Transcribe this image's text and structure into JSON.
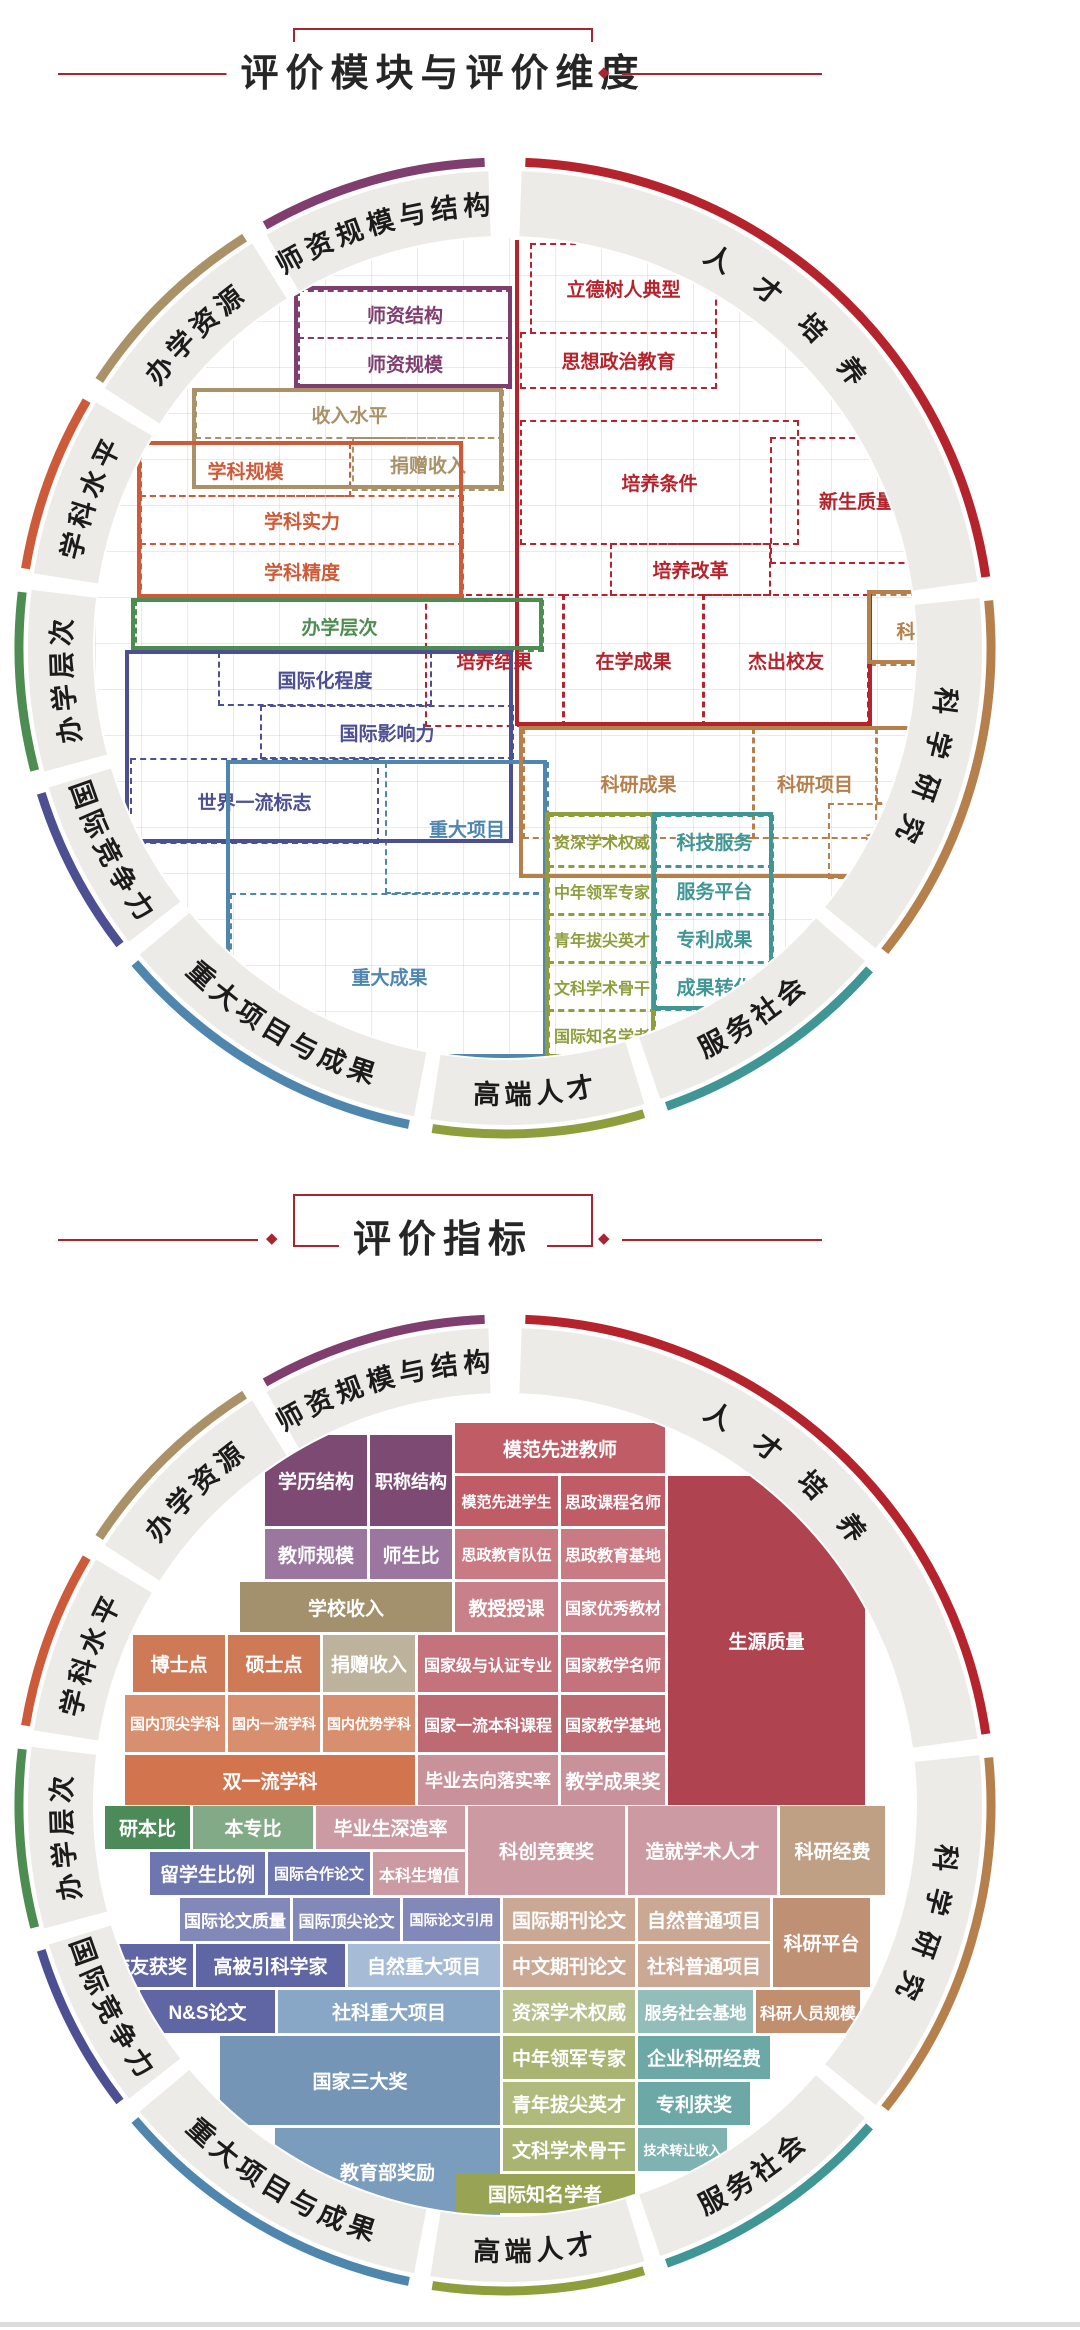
{
  "titles": {
    "module_dimension": "评价模块与评价维度",
    "indicator": "评价指标"
  },
  "accent_color": "#a82430",
  "diamond_icon": "◆",
  "module_colors": {
    "purple": "#7f3e6e",
    "red": "#b5232c",
    "tan": "#ab9168",
    "orange": "#cd5b39",
    "green": "#4e8d52",
    "navy": "#4c4f91",
    "steel": "#4f86ae",
    "camel": "#b5804c",
    "olive": "#8f9e3d",
    "teal": "#3f9695"
  },
  "ring": {
    "band_color": "#edebe8",
    "label_color": "#1b1b1b",
    "segments": [
      {
        "label": "人才培养",
        "color": "#b5232c",
        "a0": 2,
        "a1": 82,
        "flip": false
      },
      {
        "label": "科学研究",
        "color": "#b5804c",
        "a0": 84,
        "a1": 129,
        "flip": false
      },
      {
        "label": "服务社会",
        "color": "#3f9695",
        "a0": 131,
        "a1": 161,
        "flip": true
      },
      {
        "label": "高端人才",
        "color": "#8f9e3d",
        "a0": 163,
        "a1": 189,
        "flip": true
      },
      {
        "label": "重大项目与成果",
        "color": "#4f86ae",
        "a0": 191,
        "a1": 230,
        "flip": true
      },
      {
        "label": "国际竞争力",
        "color": "#4c4f91",
        "a0": 232,
        "a1": 253,
        "flip": true
      },
      {
        "label": "办学层次",
        "color": "#4e8d52",
        "a0": 255,
        "a1": 277,
        "flip": false
      },
      {
        "label": "学科水平",
        "color": "#cd5b39",
        "a0": 279,
        "a1": 301,
        "flip": false
      },
      {
        "label": "办学资源",
        "color": "#ab9168",
        "a0": 303,
        "a1": 328,
        "flip": false
      },
      {
        "label": "师资规模与结构",
        "color": "#7f3e6e",
        "a0": 330,
        "a1": 358,
        "flip": false
      }
    ]
  },
  "wheel1": {
    "cells": [
      {
        "t": "师资结构",
        "x": 203,
        "y": 52,
        "w": 210,
        "h": 45,
        "c": "purple"
      },
      {
        "t": "师资规模",
        "x": 203,
        "y": 99,
        "w": 210,
        "h": 48,
        "c": "purple"
      },
      {
        "t": "立德树人典型",
        "x": 435,
        "y": 5,
        "w": 183,
        "h": 87,
        "c": "red"
      },
      {
        "t": "思想政治教育",
        "x": 425,
        "y": 94,
        "w": 193,
        "h": 53,
        "c": "red"
      },
      {
        "t": "培养条件",
        "x": 425,
        "y": 182,
        "w": 275,
        "h": 121,
        "c": "red"
      },
      {
        "t": "培养改革",
        "x": 515,
        "y": 305,
        "w": 157,
        "h": 49,
        "c": "red"
      },
      {
        "t": "新生质量",
        "x": 675,
        "y": 199,
        "w": 170,
        "h": 123,
        "c": "red"
      },
      {
        "t": "培养结果",
        "x": 330,
        "y": 356,
        "w": 135,
        "h": 129,
        "c": "red"
      },
      {
        "t": "在学成果",
        "x": 468,
        "y": 356,
        "w": 137,
        "h": 129,
        "c": "red"
      },
      {
        "t": "杰出校友",
        "x": 608,
        "y": 356,
        "w": 162,
        "h": 129,
        "c": "red"
      },
      {
        "t": "收入水平",
        "x": 100,
        "y": 152,
        "w": 305,
        "h": 45,
        "c": "tan"
      },
      {
        "t": "捐赠收入",
        "x": 257,
        "y": 199,
        "w": 148,
        "h": 50,
        "c": "tan"
      },
      {
        "t": "学科规模",
        "x": 45,
        "y": 205,
        "w": 207,
        "h": 50,
        "c": "orange"
      },
      {
        "t": "学科实力",
        "x": 45,
        "y": 257,
        "w": 320,
        "h": 46,
        "c": "orange"
      },
      {
        "t": "学科精度",
        "x": 45,
        "y": 305,
        "w": 320,
        "h": 53,
        "c": "orange"
      },
      {
        "t": "办学层次",
        "x": 40,
        "y": 362,
        "w": 405,
        "h": 48,
        "c": "green"
      },
      {
        "t": "国际化程度",
        "x": 123,
        "y": 414,
        "w": 210,
        "h": 50,
        "c": "navy"
      },
      {
        "t": "国际影响力",
        "x": 165,
        "y": 467,
        "w": 250,
        "h": 50,
        "c": "navy"
      },
      {
        "t": "世界一流标志",
        "x": 35,
        "y": 520,
        "w": 245,
        "h": 82,
        "c": "navy"
      },
      {
        "t": "重大项目",
        "x": 290,
        "y": 524,
        "w": 160,
        "h": 128,
        "c": "steel"
      },
      {
        "t": "重大成果",
        "x": 135,
        "y": 655,
        "w": 315,
        "h": 163,
        "c": "steel"
      },
      {
        "t": "科研经费",
        "x": 775,
        "y": 356,
        "w": 125,
        "h": 68,
        "c": "camel"
      },
      {
        "t": "科研成果",
        "x": 428,
        "y": 490,
        "w": 227,
        "h": 107,
        "c": "camel"
      },
      {
        "t": "科研项目",
        "x": 658,
        "y": 490,
        "w": 120,
        "h": 107,
        "c": "camel"
      },
      {
        "t": "科研平台",
        "x": 781,
        "y": 490,
        "w": 119,
        "h": 72,
        "c": "camel"
      },
      {
        "t": "科研人力",
        "x": 733,
        "y": 565,
        "w": 147,
        "h": 72,
        "c": "camel"
      },
      {
        "t": "资深学术权威",
        "x": 453,
        "y": 577,
        "w": 104,
        "h": 48,
        "c": "olive"
      },
      {
        "t": "中年领军专家",
        "x": 453,
        "y": 628,
        "w": 104,
        "h": 45,
        "c": "olive"
      },
      {
        "t": "青年拔尖英才",
        "x": 453,
        "y": 676,
        "w": 104,
        "h": 45,
        "c": "olive"
      },
      {
        "t": "文科学术骨干",
        "x": 453,
        "y": 724,
        "w": 104,
        "h": 45,
        "c": "olive"
      },
      {
        "t": "国际知名学者",
        "x": 453,
        "y": 772,
        "w": 104,
        "h": 45,
        "c": "olive"
      },
      {
        "t": "科技服务",
        "x": 560,
        "y": 577,
        "w": 115,
        "h": 48,
        "c": "teal"
      },
      {
        "t": "服务平台",
        "x": 560,
        "y": 628,
        "w": 115,
        "h": 45,
        "c": "teal"
      },
      {
        "t": "专利成果",
        "x": 560,
        "y": 676,
        "w": 115,
        "h": 45,
        "c": "teal"
      },
      {
        "t": "成果转化",
        "x": 560,
        "y": 724,
        "w": 115,
        "h": 45,
        "c": "teal"
      }
    ],
    "outlines": [
      {
        "kind": "box",
        "x": 199,
        "y": 48,
        "w": 218,
        "h": 102,
        "c": "purple"
      },
      {
        "kind": "bar",
        "x": 420,
        "y": 2,
        "w": 4,
        "h": 486,
        "c": "red"
      },
      {
        "kind": "bar",
        "x": 420,
        "y": 484,
        "w": 357,
        "h": 4,
        "c": "red"
      },
      {
        "kind": "bar",
        "x": 773,
        "y": 352,
        "w": 4,
        "h": 136,
        "c": "red"
      },
      {
        "kind": "box",
        "x": 97,
        "y": 150,
        "w": 311,
        "h": 101,
        "c": "tan"
      },
      {
        "kind": "box",
        "x": 42,
        "y": 203,
        "w": 326,
        "h": 157,
        "c": "orange"
      },
      {
        "kind": "box",
        "x": 36,
        "y": 360,
        "w": 412,
        "h": 52,
        "c": "green"
      },
      {
        "kind": "box",
        "x": 30,
        "y": 412,
        "w": 388,
        "h": 193,
        "c": "navy"
      },
      {
        "kind": "box",
        "x": 131,
        "y": 522,
        "w": 321,
        "h": 298,
        "c": "steel"
      },
      {
        "kind": "box",
        "x": 772,
        "y": 352,
        "w": 131,
        "h": 74,
        "c": "camel"
      },
      {
        "kind": "box",
        "x": 424,
        "y": 488,
        "w": 479,
        "h": 152,
        "c": "camel"
      },
      {
        "kind": "box",
        "x": 450,
        "y": 574,
        "w": 110,
        "h": 246,
        "c": "olive"
      },
      {
        "kind": "box",
        "x": 557,
        "y": 574,
        "w": 121,
        "h": 198,
        "c": "teal"
      }
    ]
  },
  "wheel2": {
    "cells": [
      {
        "t": "模范先进教师",
        "x": 360,
        "y": 28,
        "w": 210,
        "h": 50,
        "c": "#c05c66"
      },
      {
        "t": "学历结构",
        "x": 170,
        "y": 40,
        "w": 102,
        "h": 91,
        "c": "#7c4a73"
      },
      {
        "t": "职称结构",
        "x": 275,
        "y": 40,
        "w": 82,
        "h": 91,
        "c": "#7c4a73"
      },
      {
        "t": "模范先进学生",
        "x": 360,
        "y": 81,
        "w": 103,
        "h": 50,
        "c": "#c05c66"
      },
      {
        "t": "思政课程名师",
        "x": 466,
        "y": 81,
        "w": 104,
        "h": 50,
        "c": "#c05c66"
      },
      {
        "t": "教师规模",
        "x": 170,
        "y": 134,
        "w": 102,
        "h": 50,
        "c": "#9b77a0"
      },
      {
        "t": "师生比",
        "x": 275,
        "y": 134,
        "w": 82,
        "h": 50,
        "c": "#9b77a0"
      },
      {
        "t": "思政教育队伍",
        "x": 360,
        "y": 134,
        "w": 103,
        "h": 50,
        "c": "#ca7a82"
      },
      {
        "t": "思政教育基地",
        "x": 466,
        "y": 134,
        "w": 104,
        "h": 50,
        "c": "#ca7a82"
      },
      {
        "t": "学校收入",
        "x": 145,
        "y": 187,
        "w": 212,
        "h": 50,
        "c": "#a3906c"
      },
      {
        "t": "教授授课",
        "x": 360,
        "y": 187,
        "w": 103,
        "h": 50,
        "c": "#c98189"
      },
      {
        "t": "国家优秀教材",
        "x": 466,
        "y": 187,
        "w": 104,
        "h": 50,
        "c": "#c98189"
      },
      {
        "t": "博士点",
        "x": 38,
        "y": 240,
        "w": 92,
        "h": 57,
        "c": "#ce7a57"
      },
      {
        "t": "硕士点",
        "x": 133,
        "y": 240,
        "w": 92,
        "h": 57,
        "c": "#ce7a57"
      },
      {
        "t": "捐赠收入",
        "x": 228,
        "y": 240,
        "w": 92,
        "h": 57,
        "c": "#bdb29b"
      },
      {
        "t": "国家级与认证专业",
        "x": 323,
        "y": 240,
        "w": 140,
        "h": 57,
        "c": "#c4737c"
      },
      {
        "t": "国家教学名师",
        "x": 466,
        "y": 240,
        "w": 104,
        "h": 57,
        "c": "#c4737c"
      },
      {
        "t": "生源质量",
        "x": 573,
        "y": 81,
        "w": 197,
        "h": 329,
        "c": "#b04350"
      },
      {
        "t": "国内顶尖学科",
        "x": 30,
        "y": 300,
        "w": 100,
        "h": 57,
        "c": "#d88f70"
      },
      {
        "t": "国内一流学科",
        "x": 133,
        "y": 300,
        "w": 92,
        "h": 57,
        "c": "#d88f70"
      },
      {
        "t": "国内优势学科",
        "x": 228,
        "y": 300,
        "w": 92,
        "h": 57,
        "c": "#d88f70"
      },
      {
        "t": "国家一流本科课程",
        "x": 323,
        "y": 300,
        "w": 140,
        "h": 57,
        "c": "#bd6a73"
      },
      {
        "t": "国家教学基地",
        "x": 466,
        "y": 300,
        "w": 104,
        "h": 57,
        "c": "#bd6a73"
      },
      {
        "t": "双一流学科",
        "x": 30,
        "y": 360,
        "w": 290,
        "h": 50,
        "c": "#d2744e"
      },
      {
        "t": "毕业去向落实率",
        "x": 323,
        "y": 360,
        "w": 140,
        "h": 50,
        "c": "#c9929b"
      },
      {
        "t": "教学成果奖",
        "x": 466,
        "y": 360,
        "w": 104,
        "h": 50,
        "c": "#c9929b"
      },
      {
        "t": "研本比",
        "x": 10,
        "y": 411,
        "w": 85,
        "h": 43,
        "c": "#4c8a59"
      },
      {
        "t": "本专比",
        "x": 98,
        "y": 411,
        "w": 120,
        "h": 43,
        "c": "#83aa87"
      },
      {
        "t": "毕业生深造率",
        "x": 221,
        "y": 411,
        "w": 149,
        "h": 43,
        "c": "#cc9aa3"
      },
      {
        "t": "科创竞赛奖",
        "x": 373,
        "y": 411,
        "w": 157,
        "h": 89,
        "c": "#cc9aa3"
      },
      {
        "t": "造就学术人才",
        "x": 533,
        "y": 411,
        "w": 149,
        "h": 89,
        "c": "#cc9aa3"
      },
      {
        "t": "科研经费",
        "x": 685,
        "y": 411,
        "w": 105,
        "h": 89,
        "c": "#bfa084"
      },
      {
        "t": "留学生比例",
        "x": 55,
        "y": 457,
        "w": 115,
        "h": 43,
        "c": "#6d76af"
      },
      {
        "t": "国际合作论文",
        "x": 173,
        "y": 457,
        "w": 102,
        "h": 43,
        "c": "#6d76af"
      },
      {
        "t": "本科生增值",
        "x": 278,
        "y": 457,
        "w": 92,
        "h": 43,
        "c": "#cc9aa3"
      },
      {
        "t": "国际论文质量",
        "x": 85,
        "y": 503,
        "w": 110,
        "h": 43,
        "c": "#8289b8"
      },
      {
        "t": "国际顶尖论文",
        "x": 198,
        "y": 503,
        "w": 107,
        "h": 43,
        "c": "#8289b8"
      },
      {
        "t": "国际论文引用",
        "x": 308,
        "y": 503,
        "w": 97,
        "h": 43,
        "c": "#8289b8"
      },
      {
        "t": "国际期刊论文",
        "x": 408,
        "y": 503,
        "w": 132,
        "h": 43,
        "c": "#cba893"
      },
      {
        "t": "自然普通项目",
        "x": 543,
        "y": 503,
        "w": 132,
        "h": 43,
        "c": "#cba893"
      },
      {
        "t": "科研平台",
        "x": 678,
        "y": 503,
        "w": 97,
        "h": 89,
        "c": "#c09074"
      },
      {
        "t": "校友获奖",
        "x": 10,
        "y": 549,
        "w": 88,
        "h": 43,
        "c": "#5f66a3"
      },
      {
        "t": "高被引科学家",
        "x": 101,
        "y": 549,
        "w": 149,
        "h": 43,
        "c": "#5f66a3"
      },
      {
        "t": "自然重大项目",
        "x": 253,
        "y": 549,
        "w": 152,
        "h": 43,
        "c": "#a6bcd6"
      },
      {
        "t": "中文期刊论文",
        "x": 408,
        "y": 549,
        "w": 132,
        "h": 43,
        "c": "#cba893"
      },
      {
        "t": "社科普通项目",
        "x": 543,
        "y": 549,
        "w": 132,
        "h": 43,
        "c": "#cba893"
      },
      {
        "t": "N&S论文",
        "x": 45,
        "y": 595,
        "w": 135,
        "h": 43,
        "c": "#5f66a3"
      },
      {
        "t": "社科重大项目",
        "x": 183,
        "y": 595,
        "w": 222,
        "h": 43,
        "c": "#88a7c6"
      },
      {
        "t": "资深学术权威",
        "x": 408,
        "y": 595,
        "w": 132,
        "h": 43,
        "c": "#b8c08d"
      },
      {
        "t": "服务社会基地",
        "x": 543,
        "y": 595,
        "w": 115,
        "h": 43,
        "c": "#92bdbb"
      },
      {
        "t": "科研人员规模",
        "x": 661,
        "y": 595,
        "w": 104,
        "h": 43,
        "c": "#c28f6e"
      },
      {
        "t": "国家三大奖",
        "x": 125,
        "y": 641,
        "w": 280,
        "h": 89,
        "c": "#7495b6"
      },
      {
        "t": "中年领军专家",
        "x": 408,
        "y": 641,
        "w": 132,
        "h": 43,
        "c": "#a9b472"
      },
      {
        "t": "企业科研经费",
        "x": 543,
        "y": 641,
        "w": 132,
        "h": 43,
        "c": "#6ba8a6"
      },
      {
        "t": "青年拔尖英才",
        "x": 408,
        "y": 687,
        "w": 132,
        "h": 43,
        "c": "#b0ba7c"
      },
      {
        "t": "专利获奖",
        "x": 543,
        "y": 687,
        "w": 112,
        "h": 43,
        "c": "#6ba8a6"
      },
      {
        "t": "教育部奖励",
        "x": 180,
        "y": 733,
        "w": 225,
        "h": 87,
        "c": "#7a9cbd"
      },
      {
        "t": "文科学术骨干",
        "x": 408,
        "y": 733,
        "w": 132,
        "h": 43,
        "c": "#a9b472"
      },
      {
        "t": "技术转让收入",
        "x": 543,
        "y": 733,
        "w": 89,
        "h": 43,
        "c": "#7fb3b1"
      },
      {
        "t": "国际知名学者",
        "x": 360,
        "y": 779,
        "w": 180,
        "h": 39,
        "c": "#98a353"
      }
    ]
  }
}
